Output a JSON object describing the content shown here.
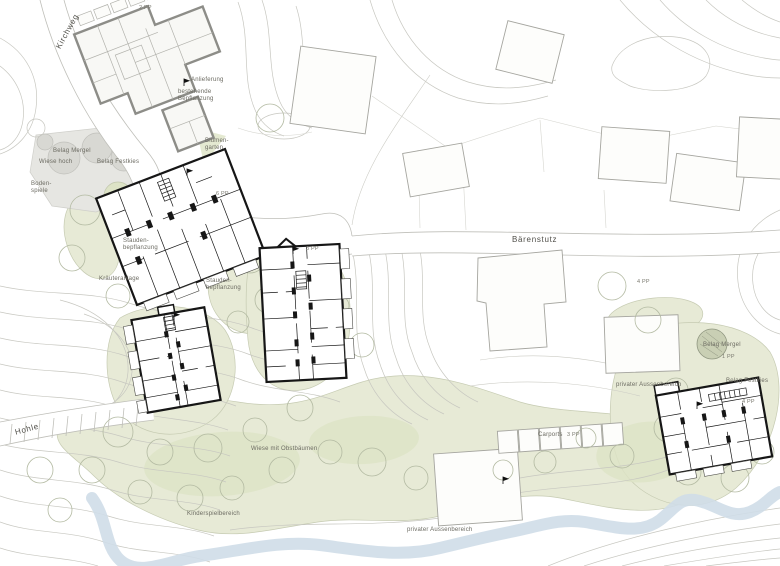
{
  "streets": {
    "kirchweg": "Kirchweg",
    "baerenstutz": "Bärenstutz",
    "hohle": "Hohle"
  },
  "labels": {
    "anlieferung": "Anlieferung",
    "bestehende_bepflanzung": "bestehende\nBepflanzung",
    "blumengarten": "Blumen-\ngarten",
    "belag_mergel": "Belag Mergel",
    "wiese_hoch": "Wiese hoch",
    "belag_festkies": "Belag Festkies",
    "bodenspiele": "Boden-\nspiele",
    "stauden": "Stauden-\nbepflanzung",
    "kraeuteranlage": "Kräuteranlage",
    "wiese_obstbaeumen": "Wiese mit Obstbäumen",
    "kinderspielbereich": "Kinderspielbereich",
    "privater_aussenbereich": "privater Aussenbereich",
    "carports": "Carports"
  },
  "parking": {
    "top": "2 PP",
    "bldg1": "6 PP",
    "bldg2": "3 PP",
    "east": "4 PP",
    "mergel": "1 PP",
    "bldg4": "4 PP",
    "carports": "3 PP"
  },
  "colors": {
    "background": "#ffffff",
    "green_area": "#e7ead6",
    "green_accent": "#dde3c6",
    "surface_gray": "#e6e6e2",
    "water_blue": "#cfdde8",
    "contour_gray": "#c7c7c0",
    "existing_building_outline": "#a3a39d",
    "new_building_black": "#161616",
    "label_text": "#6b6a61"
  }
}
